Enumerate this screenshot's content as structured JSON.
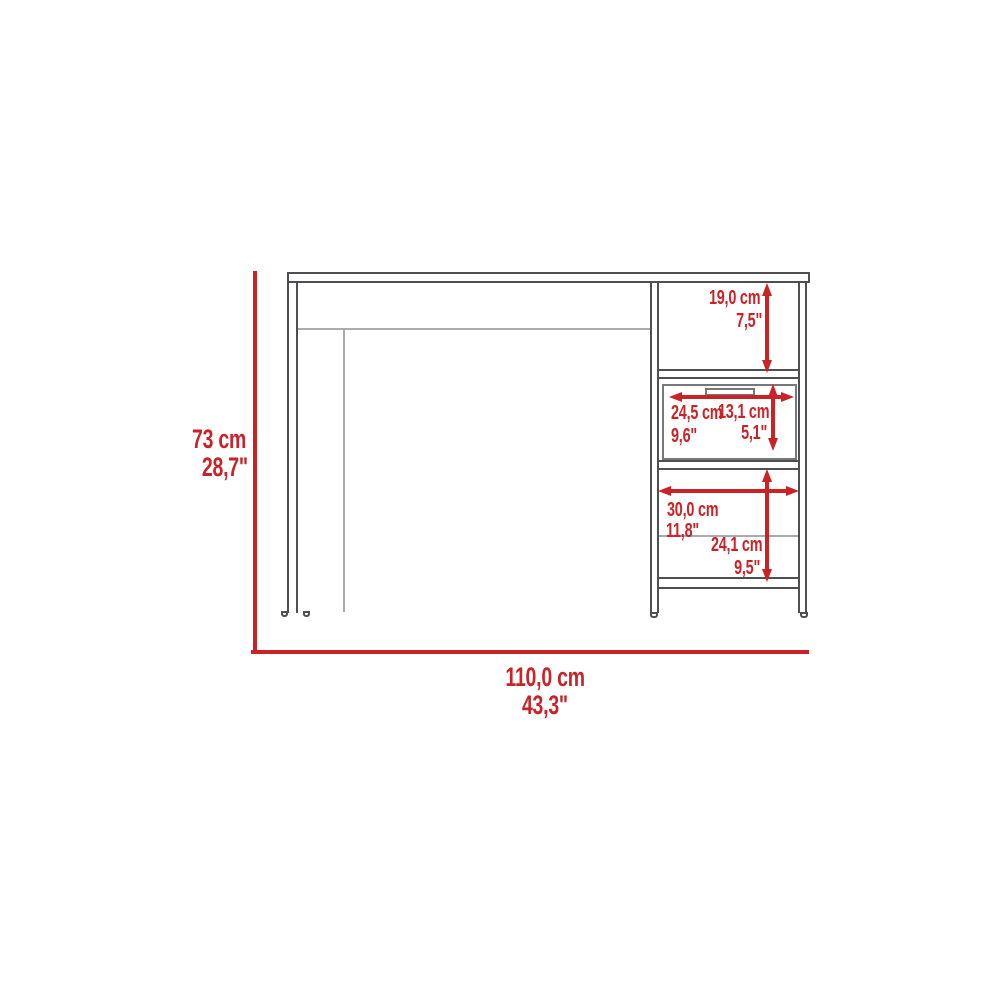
{
  "diagram": {
    "accent_color": "#c92227",
    "outline_color": "#4e4f53",
    "light_line_color": "#a9aaae",
    "dimensions": {
      "overall_height": {
        "cm": "73 cm",
        "inch": "28,7\""
      },
      "overall_width": {
        "cm": "110,0 cm",
        "inch": "43,3\""
      },
      "top_compartment_height": {
        "cm": "19,0 cm",
        "inch": "7,5\""
      },
      "drawer_width": {
        "cm": "24,5 cm",
        "inch": "9,6\""
      },
      "drawer_height": {
        "cm": "13,1 cm",
        "inch": "5,1\""
      },
      "lower_compartment_width": {
        "cm": "30,0 cm",
        "inch": "11,8\""
      },
      "lower_compartment_height": {
        "cm": "24,1 cm",
        "inch": "9,5\""
      }
    }
  }
}
